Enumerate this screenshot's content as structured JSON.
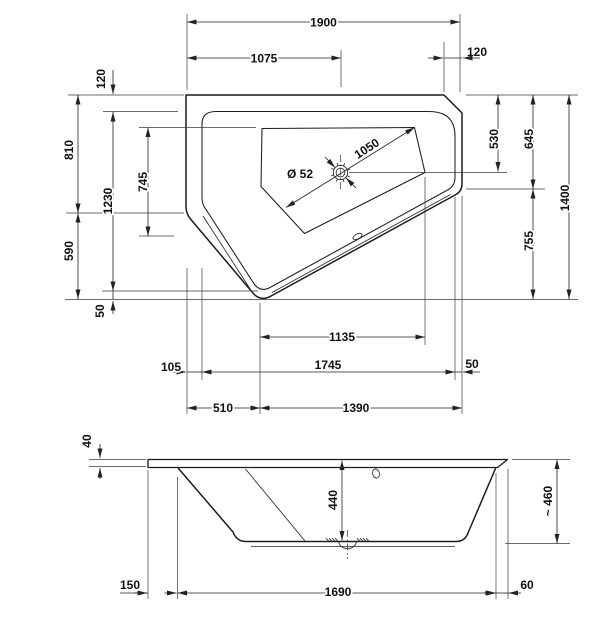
{
  "drawing": {
    "line_color": "#1c1c1c",
    "background_color": "#ffffff"
  },
  "top_view": {
    "total_width": "1900",
    "drain_from_left": "1075",
    "corner_bevel": "120",
    "rim_offset_top": "120",
    "left_upper": "810",
    "rim_height": "1230",
    "basin_height": "745",
    "left_lower": "590",
    "rim_bottom_offset": "50",
    "drain_from_top": "530",
    "right_upper": "645",
    "total_height": "1400",
    "right_lower": "755",
    "basin_diagonal": "1050",
    "drain_diameter": "Ø 52",
    "basin_width": "1135",
    "left_inset": "105",
    "rim_width": "1745",
    "right_inset": "50",
    "vertex_from_left": "510",
    "vertex_to_right": "1390"
  },
  "front_view": {
    "rim_thickness": "40",
    "inner_depth": "440",
    "overall_height": "~ 460",
    "left_overhang": "150",
    "bottom_width": "1690",
    "right_overhang": "60"
  }
}
